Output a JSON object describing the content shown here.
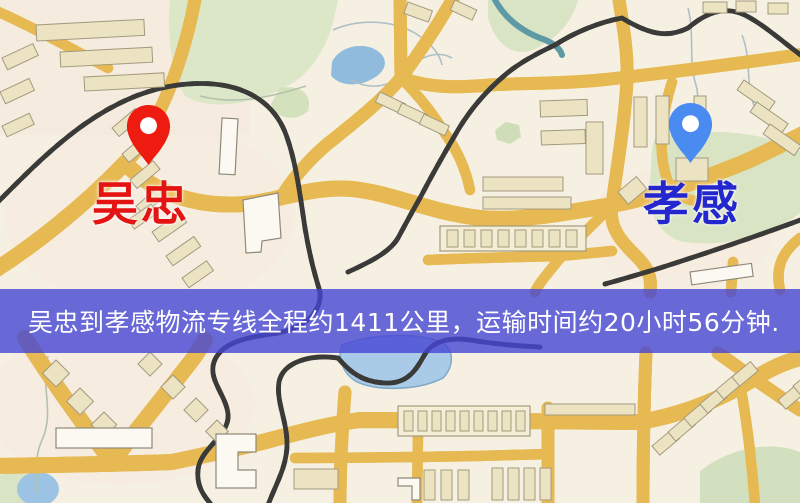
{
  "banner": {
    "text": "吴忠到孝感物流专线全程约1411公里，运输时间约20小时56分钟.",
    "background": "#4646d4",
    "text_color": "#ffffff"
  },
  "markers": {
    "origin": {
      "label": "吴忠",
      "label_color": "#e31412",
      "pin_color": "#ee1c10",
      "pin_hole_color": "#ffffff"
    },
    "destination": {
      "label": "孝感",
      "label_color": "#2427cd",
      "pin_color": "#4a8bf2",
      "pin_hole_color": "#ffffff"
    }
  },
  "map": {
    "palette": {
      "background": "#f6f0e2",
      "road_fill": "#f7d270",
      "road_casing": "#e7b952",
      "water": "#90bbdd",
      "green_area": "#dce7c8",
      "railway": "#3a3a38",
      "building": "#ece3c3"
    }
  }
}
